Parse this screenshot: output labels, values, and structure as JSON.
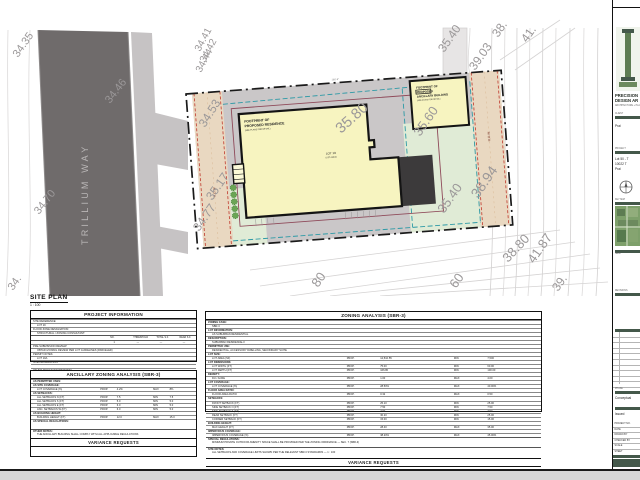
{
  "sheet": {
    "view_label": "SITE PLAN",
    "view_scale": "1 : 100"
  },
  "site_plan": {
    "street_name": "TRILLIUM  WAY",
    "residence_label": [
      "FOOTPRINT OF",
      "PROPOSED RESIDENCE",
      "(SEE PLANS FOR DETAIL)"
    ],
    "lot_label": "LOT 19",
    "lot_sublabel": "(LOT AREA)",
    "ancillary_label": [
      "FOOTPRINT OF",
      "PROPOSED",
      "ANCILLARY BUILDING",
      "(SEE PLANS FOR DETAIL)"
    ],
    "row_left": "R.O.W.",
    "row_right": "R.O.W.",
    "dim_top": "166'-9\"",
    "colors": {
      "road": "#6f6b6b",
      "sidewalk": "#c6c3c4",
      "hardscape": "#cac7c8",
      "lawn": "#e0ebd6",
      "row_band": "#ecd9c0",
      "footprint": "#f7f4c0",
      "patio": "#3c3a3b",
      "boundary": "#1a1a1a",
      "setback_teal": "#2e9aa6",
      "setback_purple": "#8f4a5a",
      "row_dash_red": "#c03a2e"
    },
    "elevations": [
      {
        "t": "34.35",
        "x": 18,
        "y": 58,
        "r": -55,
        "s": 11
      },
      {
        "t": "34.46",
        "x": 110,
        "y": 104,
        "r": -52,
        "s": 11
      },
      {
        "t": "34.70",
        "x": 39,
        "y": 215,
        "r": -52,
        "s": 11
      },
      {
        "t": "34.",
        "x": 13,
        "y": 291,
        "r": -55,
        "s": 11
      },
      {
        "t": "34.41",
        "x": 200,
        "y": 52,
        "r": -62,
        "s": 10
      },
      {
        "t": "34.42",
        "x": 205,
        "y": 63,
        "r": -62,
        "s": 10
      },
      {
        "t": "34.44",
        "x": 201,
        "y": 73,
        "r": -62,
        "s": 10
      },
      {
        "t": "34.53",
        "x": 205,
        "y": 128,
        "r": -58,
        "s": 12
      },
      {
        "t": "35.17",
        "x": 212,
        "y": 201,
        "r": -55,
        "s": 12
      },
      {
        "t": "34.77",
        "x": 199,
        "y": 232,
        "r": -55,
        "s": 12
      },
      {
        "t": "35.80",
        "x": 341,
        "y": 134,
        "r": -42,
        "s": 15
      },
      {
        "t": "35.60",
        "x": 420,
        "y": 137,
        "r": -55,
        "s": 13
      },
      {
        "t": "35.40",
        "x": 444,
        "y": 53,
        "r": -55,
        "s": 12
      },
      {
        "t": "39.03",
        "x": 475,
        "y": 71,
        "r": -55,
        "s": 12
      },
      {
        "t": "38.",
        "x": 498,
        "y": 38,
        "r": -55,
        "s": 12
      },
      {
        "t": "41.",
        "x": 527,
        "y": 43,
        "r": -55,
        "s": 12
      },
      {
        "t": "38.94",
        "x": 478,
        "y": 199,
        "r": -55,
        "s": 14
      },
      {
        "t": "35.40",
        "x": 444,
        "y": 214,
        "r": -55,
        "s": 13
      },
      {
        "t": "38.80",
        "x": 508,
        "y": 263,
        "r": -47,
        "s": 13
      },
      {
        "t": "41.87",
        "x": 534,
        "y": 264,
        "r": -55,
        "s": 13
      },
      {
        "t": "80",
        "x": 318,
        "y": 288,
        "r": -55,
        "s": 13
      },
      {
        "t": "60",
        "x": 456,
        "y": 289,
        "r": -55,
        "s": 13
      },
      {
        "t": "39.",
        "x": 558,
        "y": 292,
        "r": -55,
        "s": 12
      }
    ]
  },
  "project_info": {
    "title": "PROJECT INFORMATION",
    "rows": [
      {
        "label": "SITE REFERENCE:",
        "ind": false
      },
      {
        "label": "LOT 19",
        "ind": true
      },
      {
        "label": "FLOOD ZONE DESIGNATION:",
        "ind": false
      },
      {
        "label": "STRUCTURAL / ZONING CONSULTANT:",
        "ind": true
      }
    ],
    "grid_headers": [
      "NO.",
      "THRESHOLD",
      "TOTAL S.F.",
      "REAR S.F."
    ],
    "grid_values": [
      "1",
      "—",
      "—",
      "—"
    ],
    "rows2": [
      {
        "label": "PRE-SUBMISSION REVIEW:",
        "ind": false
      },
      {
        "label": "OBTAIN ZONING REVIEW PER LOT GUIDELINES (PARCELED)",
        "ind": true
      },
      {
        "label": "PERMIT NOTES:",
        "ind": false
      },
      {
        "label": "LOT 19A",
        "ind": true
      },
      {
        "label": "SITE INFORMATION:",
        "ind": false
      },
      {
        "label": "",
        "ind": true
      },
      {
        "label": "OTHER DESIGN INFORMATION:",
        "ind": false
      },
      {
        "label": "",
        "ind": true
      }
    ]
  },
  "zoning": {
    "title": "ZONING ANALYSIS (SBR-3)",
    "rows": [
      {
        "label": "ZONING CASE:",
        "sect": true
      },
      {
        "label": "SBR-3",
        "ind": true
      },
      {
        "label": "LOT INFORMATION:",
        "sect": true
      },
      {
        "label": "AS SUBURBAN RESIDENTIAL",
        "ind": true
      },
      {
        "label": "DESCRIPTION:",
        "sect": true
      },
      {
        "label": "SUBURBAN RESIDENCE-3",
        "ind": true
      },
      {
        "label": "PERMITTED USE:",
        "sect": true
      },
      {
        "label": "RESIDENTIAL, ACCESSORY DWELLING, SECONDARY SUITE",
        "ind": true
      },
      {
        "label": "LOT SIZE:",
        "sect": true
      },
      {
        "label": "LOT AREA (SF)",
        "ind": true,
        "c1": "PROP.",
        "v1": "12,510.55",
        "c2": "MIN",
        "v2": "7,500"
      },
      {
        "label": "LOT DIMENSIONS:",
        "sect": true
      },
      {
        "label": "LOT WIDTH (FT)",
        "ind": true,
        "c1": "PROP.",
        "v1": "75.00",
        "c2": "MIN",
        "v2": "60.00"
      },
      {
        "label": "LOT DEPTH (FT)",
        "ind": true,
        "c1": "PROP.",
        "v1": "166.80",
        "c2": "MIN",
        "v2": "100.00"
      },
      {
        "label": "DENSITY:",
        "sect": true
      },
      {
        "label": "DU / ACRE",
        "ind": true,
        "c1": "PROP.",
        "v1": "1.00",
        "c2": "MAX",
        "v2": "4.00"
      },
      {
        "label": "LOT COVERAGE:",
        "sect": true
      },
      {
        "label": "LOT COVERAGE (%)",
        "ind": true,
        "c1": "PROP.",
        "v1": "28.50%",
        "c2": "MAX",
        "v2": "40.00%"
      },
      {
        "label": "FLOOR AREA RATIO:",
        "sect": true
      },
      {
        "label": "FLOOR AREA RATIO",
        "ind": true,
        "c1": "PROP.",
        "v1": "0.32",
        "c2": "MAX",
        "v2": "0.50"
      },
      {
        "label": "SETBACKS:",
        "sect": true
      },
      {
        "label": "FRONT SETBACK (FT)",
        "ind": true,
        "c1": "PROP.",
        "v1": "25.10",
        "c2": "MIN",
        "v2": "25.00"
      },
      {
        "label": "SIDE SETBACK N (FT)",
        "ind": true,
        "c1": "PROP.",
        "v1": "7.50",
        "c2": "MIN",
        "v2": "7.50"
      },
      {
        "label": "SIDE SETBACK S (FT)",
        "ind": true,
        "c1": "PROP.",
        "v1": "7.60",
        "c2": "MIN",
        "v2": "7.50"
      },
      {
        "label": "REAR SETBACK (FT)",
        "ind": true,
        "c1": "PROP.",
        "v1": "30.20",
        "c2": "MIN",
        "v2": "25.00"
      },
      {
        "label": "CORNER SETBACK (FT)",
        "ind": true,
        "c1": "PROP.",
        "v1": "15.00",
        "c2": "MIN",
        "v2": "15.00"
      },
      {
        "label": "BUILDING HEIGHT:",
        "sect": true
      },
      {
        "label": "MAX HEIGHT (FT)",
        "ind": true,
        "c1": "PROP.",
        "v1": "28.40",
        "c2": "MAX",
        "v2": "35.00"
      },
      {
        "label": "IMPERVIOUS COVERAGE:",
        "sect": true
      },
      {
        "label": "IMPERVIOUS COVERAGE (%)",
        "ind": true,
        "c1": "PROP.",
        "v1": "38.20%",
        "c2": "MAX",
        "v2": "45.00%"
      }
    ],
    "note1_label": "SPECIAL REGULATIONS:",
    "note1_text": "MINIMUM PRIVATE OUTDOOR AMENITY SPACE SHALL BE PROVIDED PER THE ZONING ORDINANCE — SEC. 7 (SBR-3)",
    "note2_label": "SITE NOTES:",
    "note2_text": "ALL SETBACKS AND COVERAGE LIMITS SHOWN PER THE RELEVANT SBR-3 STANDARDS — 1 : 100",
    "variance_title": "VARIANCE REQUESTS"
  },
  "ancillary": {
    "title": "ANCILLARY ZONING ANALYSIS (SBR-3)",
    "rows": [
      {
        "label": "AS PERMITTED USES:",
        "sect": true
      },
      {
        "label": "AS SITE COVERAGE:",
        "sect": true
      },
      {
        "label": "LOT COVERAGE (%)",
        "ind": true,
        "c1": "PROP.",
        "v1": "4.2%",
        "c2": "MAX",
        "v2": "8%"
      },
      {
        "label": "AS SETBACKS:",
        "sect": true
      },
      {
        "label": "ALL SETBACKS N (FT)",
        "ind": true,
        "c1": "PROP.",
        "v1": "7.5",
        "c2": "MIN",
        "v2": "7.5"
      },
      {
        "label": "ALL SETBACKS S (FT)",
        "ind": true,
        "c1": "PROP.",
        "v1": "5.0",
        "c2": "MIN",
        "v2": "5.0"
      },
      {
        "label": "ALL SETBACKS E (FT)",
        "ind": true,
        "c1": "PROP.",
        "v1": "6.0",
        "c2": "MIN",
        "v2": "5.0"
      },
      {
        "label": "ANC. SETBACKS W (FT)",
        "ind": true,
        "c1": "PROP.",
        "v1": "6.0",
        "c2": "MIN",
        "v2": "5.0"
      },
      {
        "label": "AS BUILDING HEIGHT:",
        "sect": true
      },
      {
        "label": "BUILDING HEIGHT (FT)",
        "ind": true,
        "c1": "PROP.",
        "v1": "12.0",
        "c2": "MAX",
        "v2": "15.0"
      },
      {
        "label": "AS SPECIAL REGULATIONS:",
        "sect": true
      }
    ],
    "note_label": "OTHER NOTES:",
    "note_text": "THE ANCILLARY BUILDING SHALL COMPLY WITH ALL APPLICABLE REGULATIONS",
    "variance_title": "VARIANCE REQUESTS"
  },
  "titleblock": {
    "firm_line1": "PRECISION",
    "firm_line2": "DESIGN AR",
    "firm_sub": "ARCHITECTURE + PLANNING",
    "client_label": "CLIENT",
    "client_text": "Prai",
    "project_label": "PROJECT",
    "project_lines": [
      "Lot 50 - T",
      "10022 T",
      "Prai"
    ],
    "map_label": "KEY MAP",
    "seal_label": "SEAL",
    "revisions_label": "REVISIONS",
    "phase_label": "PHASE",
    "phase_text": "Conceptual",
    "issue_label": "ISSUE",
    "issue_text": "Issued",
    "kv_labels": [
      "PROJECT NO.",
      "DATE",
      "DRAWN BY",
      "CHECKED BY",
      "SCALE",
      "SHEET"
    ],
    "revision_count": 10,
    "accent_color": "#44584a"
  }
}
